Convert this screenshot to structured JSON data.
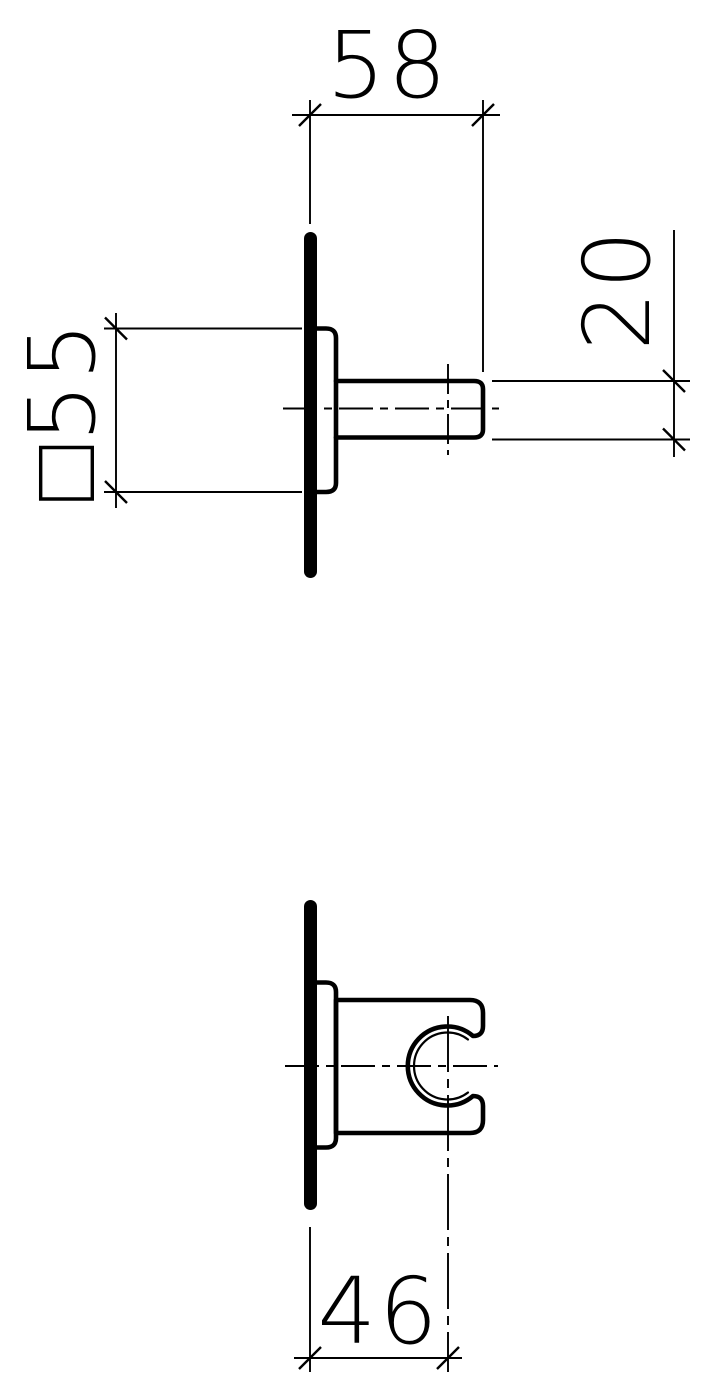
{
  "drawing": {
    "background_color": "#ffffff",
    "line_color": "#000000",
    "dimensions": {
      "projection_depth": {
        "label": "58"
      },
      "pin_diameter": {
        "label": "20"
      },
      "base_square": {
        "label": "□55"
      },
      "clip_center_offset": {
        "label": "46"
      }
    }
  }
}
